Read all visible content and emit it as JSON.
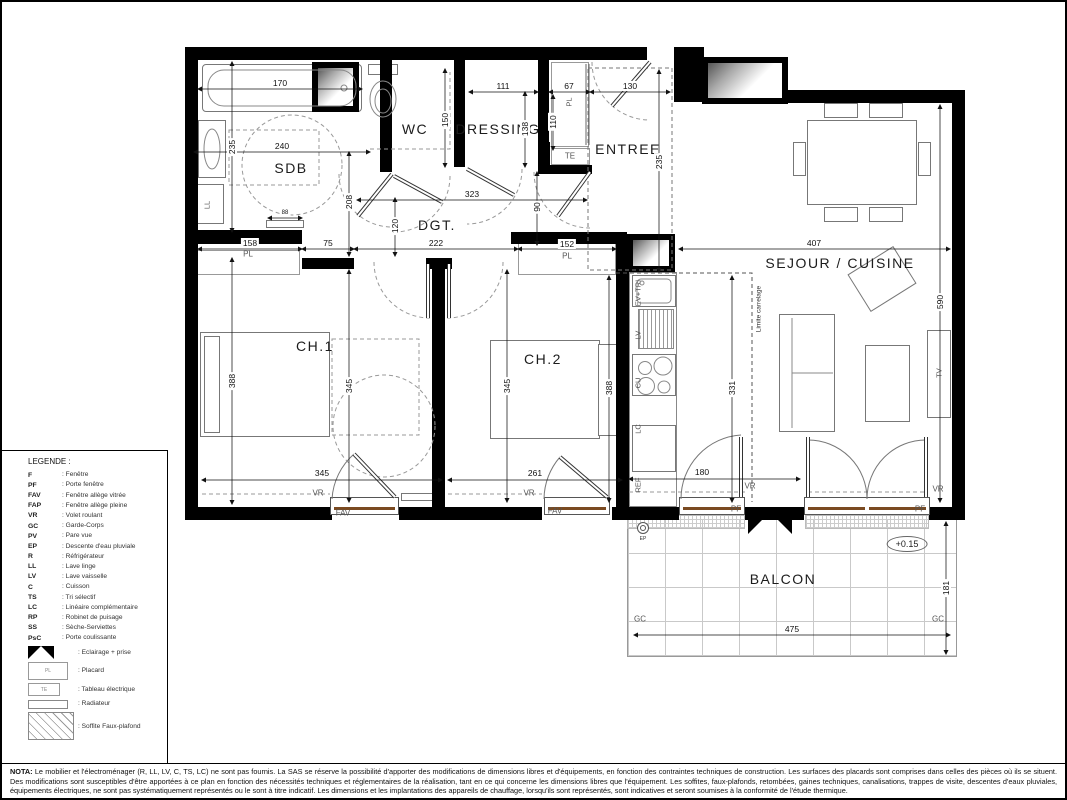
{
  "plan": {
    "rooms": [
      {
        "t": "SDB",
        "x": 289,
        "y": 166,
        "n": "room-label-sdb"
      },
      {
        "t": "WC",
        "x": 413,
        "y": 127,
        "n": "room-label-wc"
      },
      {
        "t": "DRESSING",
        "x": 496,
        "y": 127,
        "n": "room-label-dressing"
      },
      {
        "t": "ENTREE",
        "x": 626,
        "y": 147,
        "n": "room-label-entree"
      },
      {
        "t": "DGT.",
        "x": 435,
        "y": 223,
        "n": "room-label-dgt"
      },
      {
        "t": "CH.1",
        "x": 313,
        "y": 344,
        "n": "room-label-ch1"
      },
      {
        "t": "CH.2",
        "x": 541,
        "y": 357,
        "n": "room-label-ch2"
      },
      {
        "t": "SEJOUR / CUISINE",
        "x": 838,
        "y": 261,
        "n": "room-label-sejour-cuisine"
      },
      {
        "t": "BALCON",
        "x": 781,
        "y": 577,
        "n": "room-label-balcon"
      }
    ],
    "labels": [
      {
        "t": "PL",
        "x": 246,
        "y": 252,
        "cls": "tag",
        "n": "placard-ch1-label"
      },
      {
        "t": "PL",
        "x": 565,
        "y": 254,
        "cls": "tag",
        "n": "placard-ch2-label"
      },
      {
        "t": "PL",
        "x": 567,
        "y": 100,
        "cls": "tagv",
        "n": "placard-entree-label"
      },
      {
        "t": "TE",
        "x": 568,
        "y": 154,
        "cls": "tag",
        "n": "electrical-panel-label"
      },
      {
        "t": "PF",
        "x": 734,
        "y": 507,
        "cls": "tag",
        "n": "door-window-tag-pf-kitchen"
      },
      {
        "t": "PF",
        "x": 918,
        "y": 507,
        "cls": "tag",
        "n": "door-window-tag-pf-sejour"
      },
      {
        "t": "FAV",
        "x": 341,
        "y": 511,
        "cls": "tag",
        "n": "window-tag-fav-ch1"
      },
      {
        "t": "FAV",
        "x": 553,
        "y": 509,
        "cls": "tag",
        "n": "window-tag-fav-ch2"
      },
      {
        "t": "VR",
        "x": 316,
        "y": 491,
        "cls": "tag",
        "n": "shutter-tag-vr-ch1"
      },
      {
        "t": "VR",
        "x": 527,
        "y": 491,
        "cls": "tag",
        "n": "shutter-tag-vr-ch2"
      },
      {
        "t": "VR",
        "x": 748,
        "y": 484,
        "cls": "tag",
        "n": "shutter-tag-vr-kitchen"
      },
      {
        "t": "VR",
        "x": 936,
        "y": 487,
        "cls": "tag",
        "n": "shutter-tag-vr-sejour"
      },
      {
        "t": "GC",
        "x": 638,
        "y": 617,
        "cls": "tag",
        "n": "railing-tag-gc-left"
      },
      {
        "t": "GC",
        "x": 936,
        "y": 617,
        "cls": "tag",
        "n": "railing-tag-gc-right"
      },
      {
        "t": "LL",
        "x": 205,
        "y": 203,
        "cls": "tagv",
        "n": "washing-machine-label"
      },
      {
        "t": "TV",
        "x": 937,
        "y": 371,
        "cls": "tagv",
        "n": "tv-label"
      },
      {
        "t": "EV+TRI",
        "x": 636,
        "y": 291,
        "cls": "tagv",
        "n": "kitchen-sink-label"
      },
      {
        "t": "LV",
        "x": 636,
        "y": 333,
        "cls": "tagv",
        "n": "dishwasher-label"
      },
      {
        "t": "CU",
        "x": 636,
        "y": 381,
        "cls": "tagv",
        "n": "hob-label"
      },
      {
        "t": "LC",
        "x": 636,
        "y": 427,
        "cls": "tagv",
        "n": "kitchen-lc-label"
      },
      {
        "t": "REF",
        "x": 636,
        "y": 483,
        "cls": "tagv",
        "n": "fridge-label"
      },
      {
        "t": "Limite carrelage",
        "x": 757,
        "y": 307,
        "cls": "tagv small",
        "n": "tile-limit-label"
      },
      {
        "t": "EP",
        "x": 641,
        "y": 537,
        "cls": "tiny",
        "n": "downspout-label"
      },
      {
        "t": "+0.15",
        "x": 905,
        "y": 542,
        "cls": "level",
        "n": "level-label"
      }
    ],
    "dims": [
      {
        "v": "170",
        "x": 278,
        "y": 81,
        "o": "h"
      },
      {
        "v": "240",
        "x": 280,
        "y": 144,
        "o": "h"
      },
      {
        "v": "111",
        "x": 501,
        "y": 84,
        "o": "h"
      },
      {
        "v": "67",
        "x": 567,
        "y": 84,
        "o": "h"
      },
      {
        "v": "130",
        "x": 628,
        "y": 84,
        "o": "h"
      },
      {
        "v": "323",
        "x": 470,
        "y": 192,
        "o": "h"
      },
      {
        "v": "158",
        "x": 248,
        "y": 241,
        "o": "h"
      },
      {
        "v": "75",
        "x": 326,
        "y": 241,
        "o": "h"
      },
      {
        "v": "222",
        "x": 434,
        "y": 241,
        "o": "h"
      },
      {
        "v": "152",
        "x": 565,
        "y": 242,
        "o": "h"
      },
      {
        "v": "407",
        "x": 812,
        "y": 241,
        "o": "h"
      },
      {
        "v": "345",
        "x": 320,
        "y": 471,
        "o": "h"
      },
      {
        "v": "261",
        "x": 533,
        "y": 471,
        "o": "h"
      },
      {
        "v": "180",
        "x": 700,
        "y": 470,
        "o": "h"
      },
      {
        "v": "475",
        "x": 790,
        "y": 627,
        "o": "h"
      },
      {
        "v": "88",
        "x": 283,
        "y": 211,
        "o": "h",
        "cls": "tinydim"
      },
      {
        "v": "235",
        "x": 230,
        "y": 145,
        "o": "v"
      },
      {
        "v": "388",
        "x": 230,
        "y": 379,
        "o": "v"
      },
      {
        "v": "150",
        "x": 443,
        "y": 118,
        "o": "v"
      },
      {
        "v": "138",
        "x": 523,
        "y": 127,
        "o": "v"
      },
      {
        "v": "110",
        "x": 551,
        "y": 120,
        "o": "v"
      },
      {
        "v": "235",
        "x": 657,
        "y": 160,
        "o": "v"
      },
      {
        "v": "90",
        "x": 535,
        "y": 205,
        "o": "v"
      },
      {
        "v": "120",
        "x": 393,
        "y": 224,
        "o": "v"
      },
      {
        "v": "208",
        "x": 347,
        "y": 200,
        "o": "v"
      },
      {
        "v": "345",
        "x": 347,
        "y": 384,
        "o": "v"
      },
      {
        "v": "345",
        "x": 505,
        "y": 384,
        "o": "v"
      },
      {
        "v": "388",
        "x": 607,
        "y": 386,
        "o": "v"
      },
      {
        "v": "331",
        "x": 730,
        "y": 386,
        "o": "v"
      },
      {
        "v": "590",
        "x": 938,
        "y": 300,
        "o": "v"
      },
      {
        "v": "181",
        "x": 944,
        "y": 586,
        "o": "v"
      }
    ]
  },
  "legend": {
    "title": "LEGENDE :",
    "items": [
      {
        "abbr": "F",
        "desc": "Fenêtre"
      },
      {
        "abbr": "PF",
        "desc": "Porte fenêtre"
      },
      {
        "abbr": "FAV",
        "desc": "Fenêtre allège vitrée"
      },
      {
        "abbr": "FAP",
        "desc": "Fenêtre allège pleine"
      },
      {
        "abbr": "VR",
        "desc": "Volet roulant"
      },
      {
        "abbr": "GC",
        "desc": "Garde-Corps"
      },
      {
        "abbr": "PV",
        "desc": "Pare vue"
      },
      {
        "abbr": "EP",
        "desc": "Descente d'eau pluviale"
      },
      {
        "abbr": "R",
        "desc": "Réfrigérateur"
      },
      {
        "abbr": "LL",
        "desc": "Lave linge"
      },
      {
        "abbr": "LV",
        "desc": "Lave vaisselle"
      },
      {
        "abbr": "C",
        "desc": "Cuisson"
      },
      {
        "abbr": "TS",
        "desc": "Tri sélectif"
      },
      {
        "abbr": "LC",
        "desc": "Linéaire complémentaire"
      },
      {
        "abbr": "RP",
        "desc": "Robinet de puisage"
      },
      {
        "abbr": "SS",
        "desc": "Sèche-Serviettes"
      },
      {
        "abbr": "PsC",
        "desc": "Porte coulissante"
      }
    ],
    "symbol_items": [
      {
        "sym": "bowtie",
        "desc": "Eclairage + prise",
        "n": "lighting-socket-symbol"
      },
      {
        "sym": "placard",
        "sym_text": "PL",
        "desc": "Placard",
        "n": "placard-symbol"
      },
      {
        "sym": "te",
        "sym_text": "TE",
        "desc": "Tableau électrique",
        "n": "electrical-panel-symbol"
      },
      {
        "sym": "radiateur",
        "desc": "Radiateur",
        "n": "radiator-symbol"
      },
      {
        "sym": "soffite",
        "desc": "Soffite Faux-plafond",
        "n": "soffit-symbol"
      }
    ]
  },
  "nota": {
    "label": "NOTA:",
    "text": " Le mobilier et l'électroménager (R, LL, LV, C, TS, LC) ne sont pas fournis. La SAS se réserve la possibilité d'apporter des modifications de dimensions libres et d'équipements, en fonction des contraintes techniques de construction. Les surfaces des placards sont comprises dans celles des pièces où ils se situent. Des modifications sont susceptibles d'être apportées à ce plan en fonction des nécessités techniques et réglementaires de la réalisation, tant en ce qui concerne les dimensions libres que l'équipement. Les soffites, faux-plafonds, retombées, gaines techniques, canalisations, trappes de visite, descentes d'eaux pluviales, équipements électriques, ne sont pas systématiquement représentés ou le sont à titre indicatif. Les dimensions et les implantations des appareils de chauffage, lorsqu'ils sont représentés, sont indicatives et seront soumises à la conformité de l'étude thermique."
  }
}
